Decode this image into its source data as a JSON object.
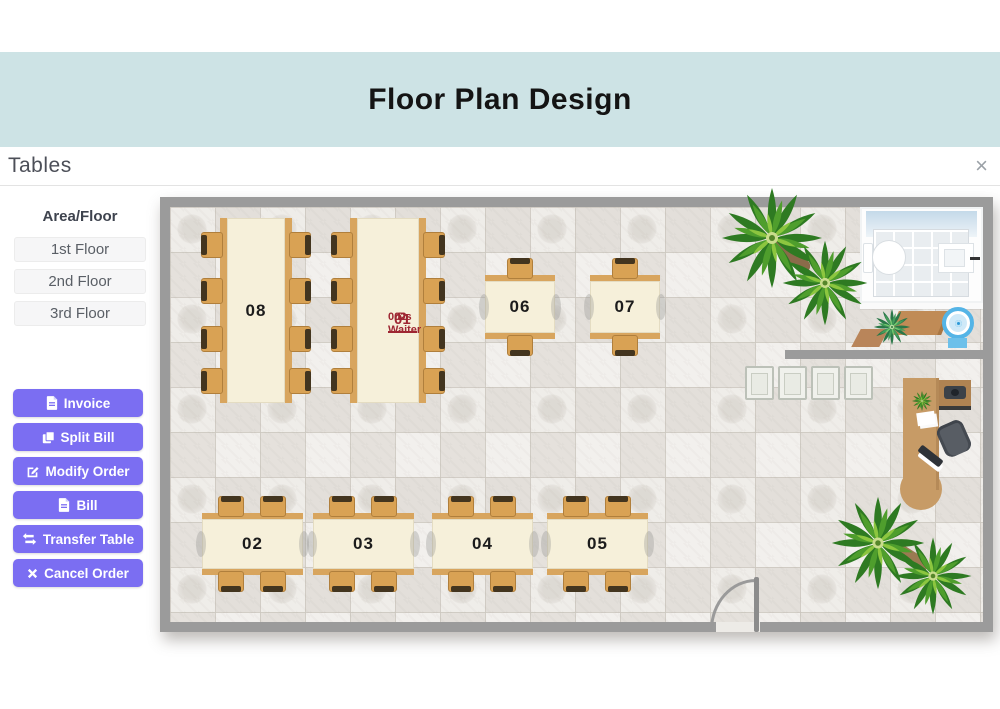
{
  "header": {
    "title": "Floor Plan Design",
    "background_color": "#cde3e5"
  },
  "modal": {
    "title": "Tables",
    "close_glyph": "×"
  },
  "sidebar": {
    "heading": "Area/Floor",
    "floors": [
      "1st Floor",
      "2nd Floor",
      "3rd Floor"
    ],
    "actions": [
      {
        "label": "Invoice",
        "icon": "invoice-file-icon"
      },
      {
        "label": "Split Bill",
        "icon": "split-bill-copy-icon"
      },
      {
        "label": "Modify Order",
        "icon": "modify-order-edit-icon"
      },
      {
        "label": "Bill",
        "icon": "bill-file-icon"
      },
      {
        "label": "Transfer Table",
        "icon": "transfer-arrows-icon"
      },
      {
        "label": "Cancel Order",
        "icon": "cancel-x-icon"
      }
    ],
    "accent_color": "#7b6ef2"
  },
  "floor_plan": {
    "wall_color": "#9b9b9b",
    "occupied_label_color": "#9e2733",
    "tables": [
      {
        "id": "01",
        "label": "01",
        "waiter_name": "Ds Waiter",
        "waiter_code": "002",
        "seats": 8
      },
      {
        "id": "02",
        "label": "02",
        "seats": 4
      },
      {
        "id": "03",
        "label": "03",
        "seats": 4
      },
      {
        "id": "04",
        "label": "04",
        "seats": 4
      },
      {
        "id": "05",
        "label": "05",
        "seats": 4
      },
      {
        "id": "06",
        "label": "06",
        "seats": 2
      },
      {
        "id": "07",
        "label": "07",
        "seats": 2
      },
      {
        "id": "08",
        "label": "08",
        "seats": 8
      }
    ]
  }
}
